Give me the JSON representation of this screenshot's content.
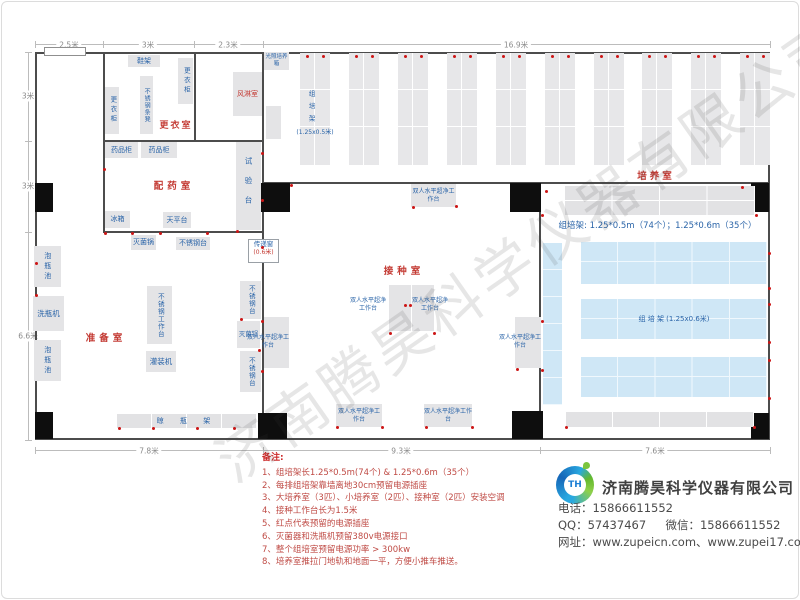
{
  "watermark": {
    "text": "济南腾昊科学仪器有限公司"
  },
  "dimensions": {
    "top": [
      "2.5米",
      "3米",
      "2.3米",
      "16.9米"
    ],
    "left": [
      "3米",
      "3米",
      "6.6米"
    ],
    "bottom": [
      "7.8米",
      "9.3米",
      "7.6米"
    ]
  },
  "rooms": {
    "changing": "更衣室",
    "air_shower": "风淋室",
    "dispensing": "配药室",
    "prep": "准备室",
    "inoculation": "接种室",
    "culture": "培养室"
  },
  "equipment": {
    "shoe_rack": "鞋架",
    "locker": "更衣柜",
    "ss_stool": "不锈钢条凳",
    "light_incubator": "光照培养箱",
    "medicine_cabinet": "药品柜",
    "test_bench": "试验台",
    "fridge": "冰箱",
    "balance_table": "天平台",
    "sterilizer": "灭菌锅",
    "ss_table": "不锈钢台",
    "pass_window": "传递窗",
    "pass_window_size": "(0.6米)",
    "soak_pool": "泡瓶池",
    "bottle_washer": "洗瓶机",
    "ss_workbench": "不锈钢工作台",
    "filling_machine": "灌装机",
    "bottle_drying_rack": "晾 瓶 架",
    "laminar": "双人水平超净工作台",
    "tissue_rack_vertical": "组培架",
    "rack_small_size": "(1.25x0.5米)",
    "rack_large_label": "组 培 架 (1.25x0.6米)"
  },
  "culture": {
    "spec_line": "组培架: 1.25*0.5m（74个）；1.25*0.6m（35个）"
  },
  "notes": {
    "heading": "备注:",
    "items": [
      "1、组培架长1.25*0.5m(74个) & 1.25*0.6m（35个）",
      "2、每排组培架靠墙离地30cm预留电源插座",
      "3、大培养室（3匹）、小培养室（2匹）、接种室（2匹）安装空调",
      "4、接种工作台长为1.5米",
      "5、红点代表预留的电源插座",
      "6、灭菌器和洗瓶机预留380v电源接口",
      "7、整个组培室预留电源功率 > 300kw",
      "8、培养室推拉门地轨和地面一平，方便小推车推送。"
    ]
  },
  "company": {
    "name": "济南腾昊科学仪器有限公司",
    "logo_text": "TH",
    "phone_label": "电话：",
    "phone": "15866611552",
    "qq_label": "QQ：",
    "qq": "57437467",
    "wechat_label": "微信：",
    "wechat": "15866611552",
    "web_label": "网址：",
    "web": "www.zupeicn.com、www.zupei17.com"
  }
}
